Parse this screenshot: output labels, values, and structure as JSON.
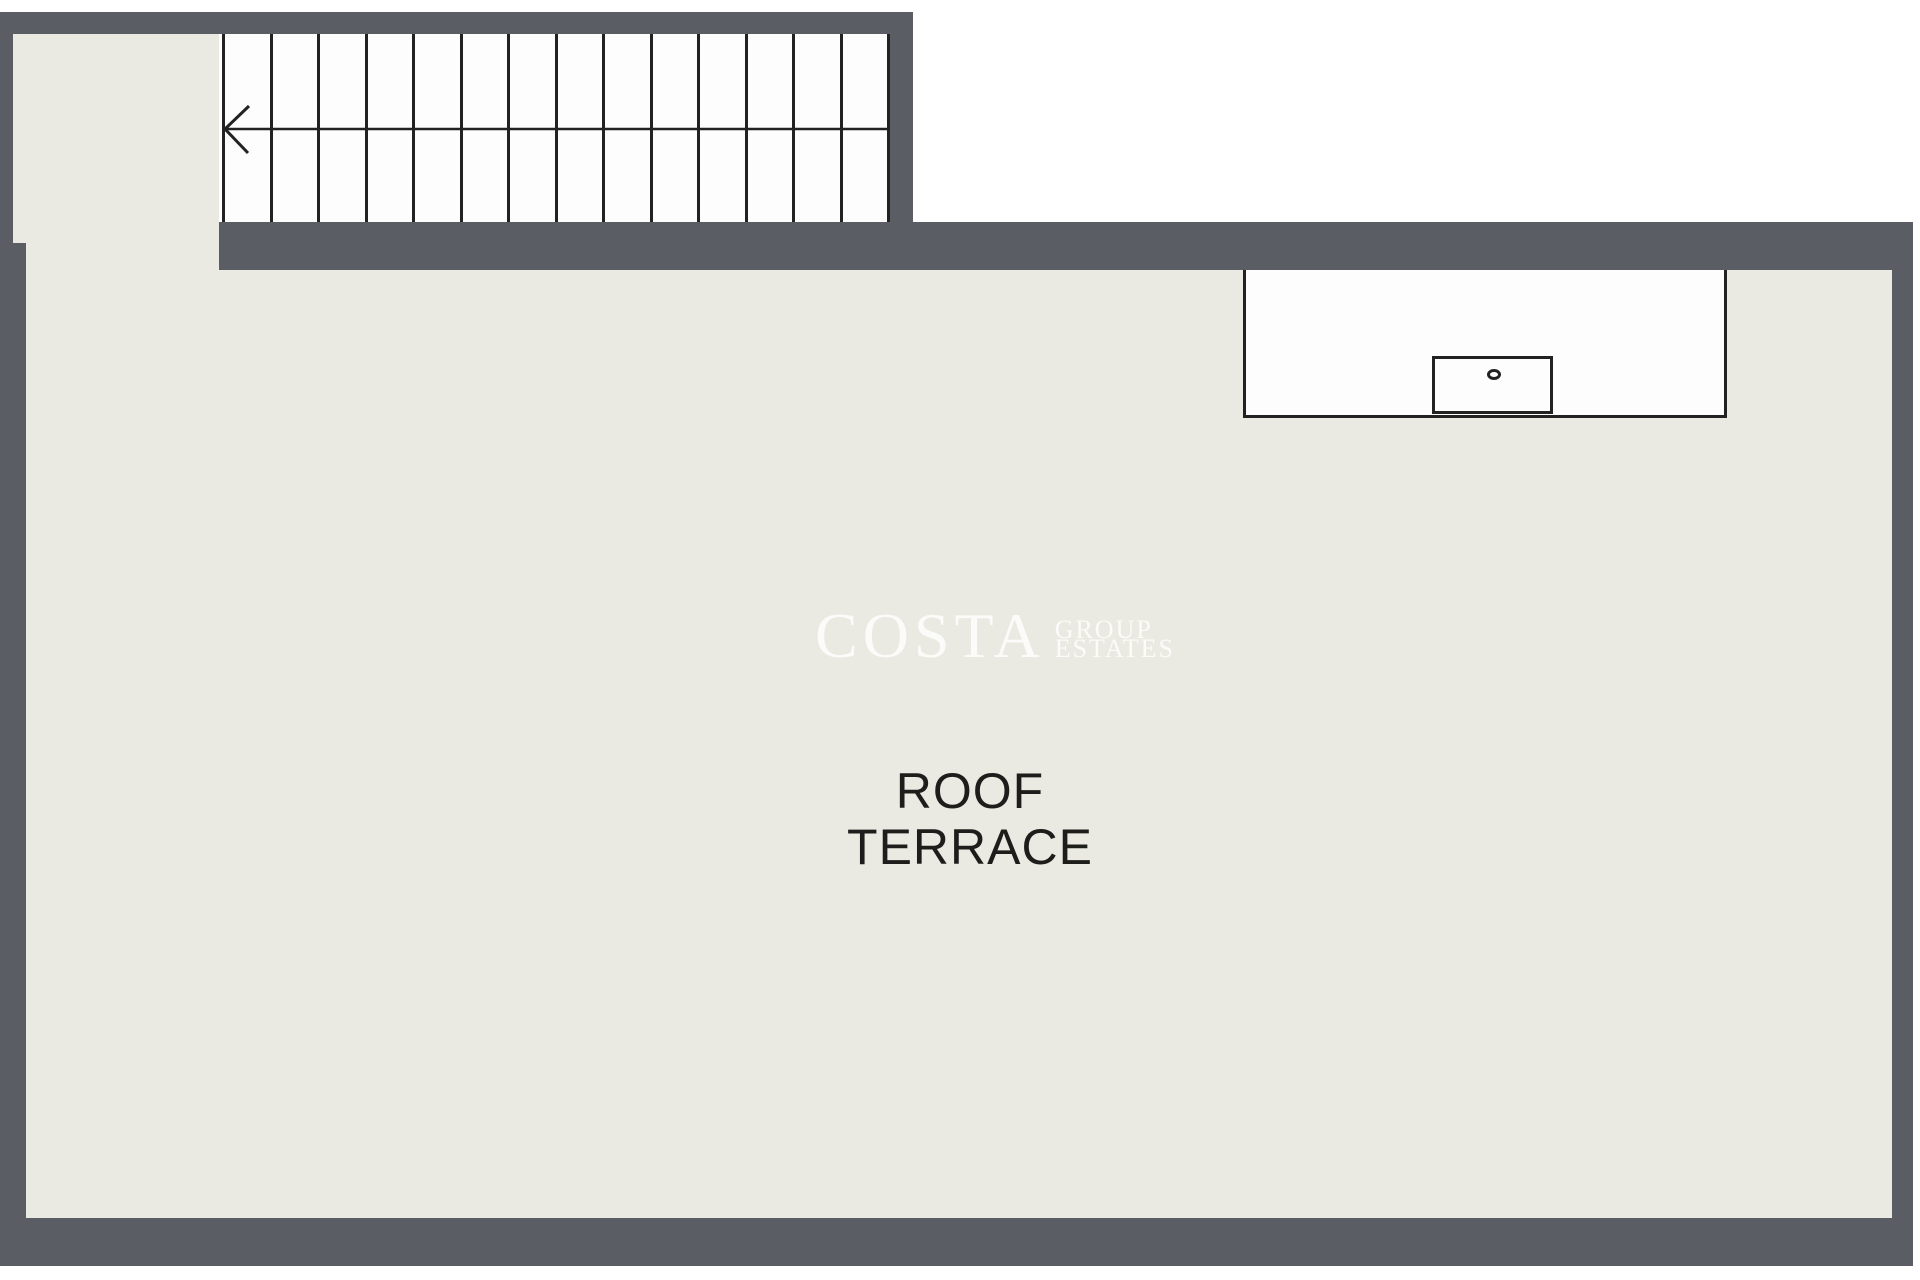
{
  "floorplan": {
    "room": {
      "label_line1": "ROOF",
      "label_line2": "TERRACE"
    },
    "watermark": {
      "primary": "COSTA",
      "secondary": [
        "GROUP",
        "ESTATES"
      ]
    },
    "stairs": {
      "tread_count": 14,
      "direction": "left"
    },
    "fixtures": {
      "counter": "counter-unit",
      "sink": "sink-basin",
      "drain": "drain"
    },
    "colors": {
      "page": "#ffffff",
      "wall": "#5a5e64",
      "floor": "#ebeae2",
      "tread": "#fdfdfd",
      "line": "#222222",
      "label": "#1d1d1b",
      "watermark": "rgba(255,255,255,0.78)"
    }
  }
}
